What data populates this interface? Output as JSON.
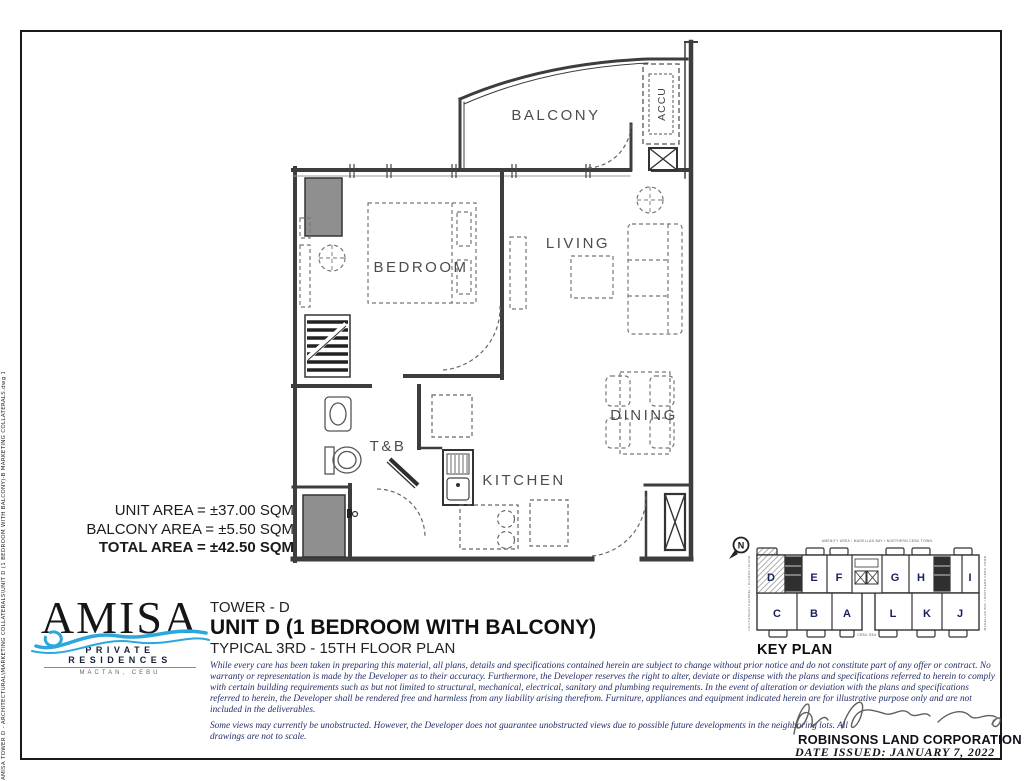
{
  "page": {
    "stamp": "AMISA TOWER D - ARCHITECTURAL\\MARKETING COLLATERALS\\UNIT D (1 BEDROOM WITH BALCONY)-B MARKETING COLLATERALS.dwg  12.04.2021"
  },
  "plan": {
    "labels": {
      "balcony": "BALCONY",
      "bedroom": "BEDROOM",
      "living": "LIVING",
      "dining": "DINING",
      "kitchen": "KITCHEN",
      "toilet_bath": "T&B",
      "accu": "ACCU"
    }
  },
  "areas": {
    "unit": "UNIT AREA = ±37.00 SQM",
    "balcony": "BALCONY AREA = ±5.50 SQM",
    "total": "TOTAL AREA = ±42.50 SQM"
  },
  "brand": {
    "name": "AMISA",
    "tagline": "PRIVATE RESIDENCES",
    "location": "MACTAN, CEBU"
  },
  "title_block": {
    "tower": "TOWER - D",
    "unit": "UNIT D (1 BEDROOM WITH BALCONY)",
    "plan_type": "TYPICAL 3RD - 15TH FLOOR PLAN"
  },
  "disclaimer": {
    "paragraph1": "While every care has been taken in preparing this material, all plans, details and specifications contained herein are subject to change without prior notice and do not constitute part of any offer or contract. No warranty or representation is made by the Developer as to their accuracy.  Furthermore, the Developer reserves the right to alter, deviate or dispense with the plans and specifications referred to herein to comply with certain building requirements such as but not limited to structural, mechanical, electrical, sanitary and plumbing requirements. In the event of alteration or deviation with the plans and specifications referred to herein, the Developer shall be rendered free and harmless from any liability arising therefrom. Furniture, appliances and equipment indicated herein are for illustrative purpose only and are not included in the deliverables.",
    "paragraph2": "Some views may currently be unobstructed. However, the Developer does not guarantee unobstructed views due to possible future developments in the neighboring lots. All drawings are not to scale."
  },
  "footer": {
    "company": "ROBINSONS LAND CORPORATION",
    "date_issued": "DATE ISSUED:  JANUARY 7, 2022"
  },
  "key_plan": {
    "title": "KEY PLAN",
    "north_label": "N",
    "top_caption": "AMENITY AREA / MAGELLAN BAY / NORTHERN CEBU TOWN",
    "left_caption": "HILUTUNGAN CHANNEL / OLANGO ISLAND",
    "right_caption": "MAGELLAN BAY / NORTHERN CEBU TOWN",
    "bottom_caption": "CEBU SEA",
    "highlighted_unit": "D",
    "units_top": [
      "D",
      "E",
      "F",
      "G",
      "H",
      "I"
    ],
    "units_bottom": [
      "C",
      "B",
      "A",
      "L",
      "K",
      "J"
    ]
  },
  "colors": {
    "wave_blue": "#2ba7dd",
    "unit_letter_navy": "#1b2160",
    "disclaimer_ink": "#22306b",
    "wall_gray": "#3d3d3d"
  }
}
